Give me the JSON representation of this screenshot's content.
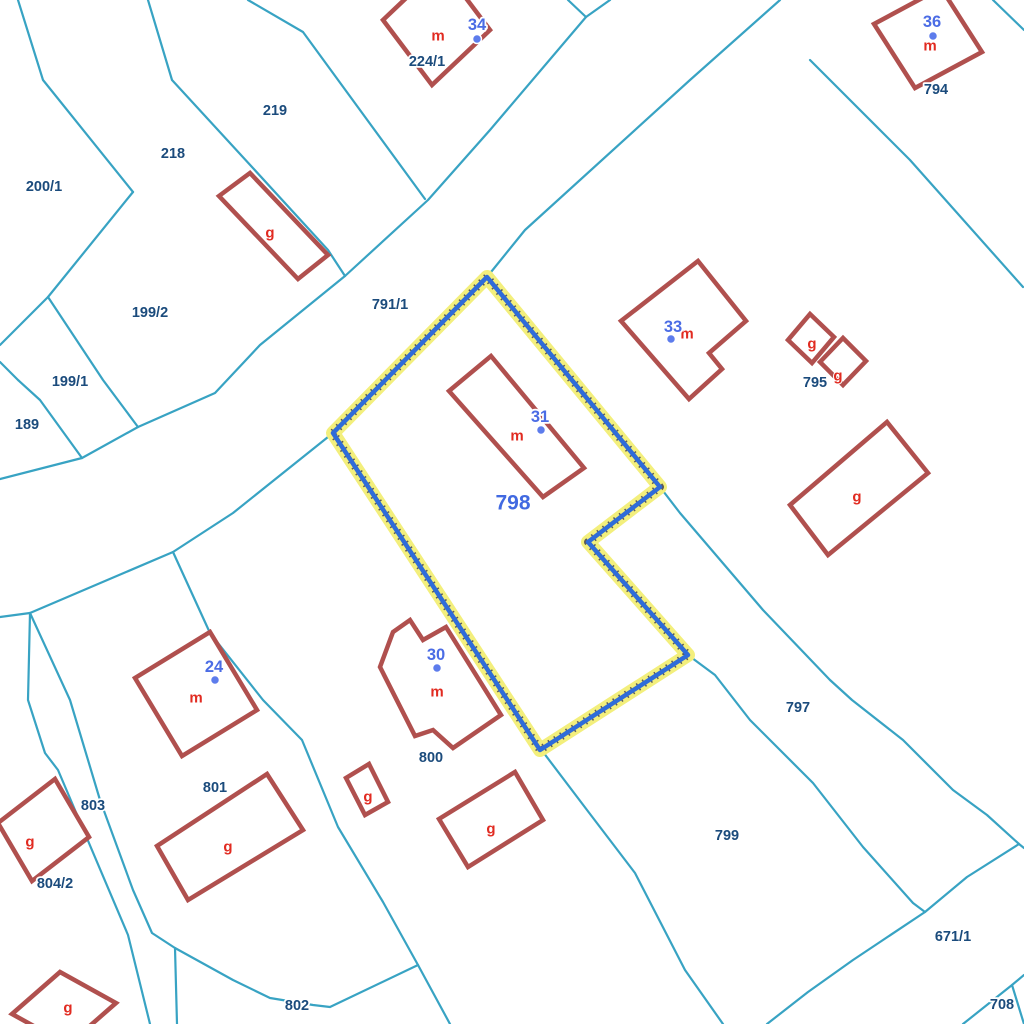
{
  "map": {
    "background": "#ffffff",
    "colors": {
      "parcel_line": "#38a3c3",
      "building_stroke": "#b0504e",
      "building_fill": "#ffffff",
      "selection_halo": "#f3ef7c",
      "selection_dots": "#5a5a5a",
      "selection_line": "#2f6cd9",
      "parcel_label": "#1b4b7c",
      "selected_parcel_label": "#4169e1",
      "house_number": "#4b6ce5",
      "house_dot": "#5d7cec",
      "type_letter": "#e12b21"
    },
    "parcel_lines": [
      {
        "points": "568,0 586,17 490,130 428,200 345,276 260,345 215,393 138,427 82,458 0,479"
      },
      {
        "points": "610,0 586,17"
      },
      {
        "points": "780,0 690,80 525,230 487,277"
      },
      {
        "points": "333,433 233,513 173,552 30,613 0,617"
      },
      {
        "points": "18,0 43,80 133,192"
      },
      {
        "points": "148,0 172,80 252,167 328,250 345,276"
      },
      {
        "points": "248,0 303,32 425,199"
      },
      {
        "points": "133,192 48,297 0,345"
      },
      {
        "points": "48,297 103,380 138,427"
      },
      {
        "points": "0,362 18,380 40,400 82,458"
      },
      {
        "points": "30,613 28,700 45,753 58,770 128,935 150,1024"
      },
      {
        "points": "30,613 70,700 100,800 133,890 152,933 175,948 177,1024"
      },
      {
        "points": "175,948 233,980 270,998 313,1005 330,1007 418,965"
      },
      {
        "points": "173,552 210,633 263,700 302,740 338,827 383,902 418,965 450,1024"
      },
      {
        "points": "540,748 587,810 635,873 685,970 723,1024"
      },
      {
        "points": "688,655 715,675 750,720 813,783 863,847 913,903 925,912"
      },
      {
        "points": "660,487 680,513 763,610 830,680 852,700 903,740 953,790 987,815 1019,844 1024,848"
      },
      {
        "points": "1019,844 967,877 925,912 880,942 853,960 808,992 767,1024"
      },
      {
        "points": "810,60 910,160 1023,287"
      },
      {
        "points": "993,0 1024,30"
      },
      {
        "points": "963,1024 1012,985 1024,975"
      },
      {
        "points": "1012,985 1024,1024"
      }
    ],
    "selected_parcel": {
      "id": "798",
      "points": "487,277 333,433 540,750 688,655 588,542 660,487",
      "label": {
        "text": "798",
        "x": 513,
        "y": 503
      }
    },
    "buildings": [
      {
        "points": "383,20 441,-35 490,30 432,85"
      },
      {
        "points": "874,24 941,-12 982,52 915,88"
      },
      {
        "points": "219,196 250,173 328,255 298,279"
      },
      {
        "points": "698,261 746,321 709,353 722,369 689,399 621,321"
      },
      {
        "points": "788,340 810,314 834,337 812,363"
      },
      {
        "points": "820,362 843,338 866,361 843,385"
      },
      {
        "points": "790,505 887,422 928,473 828,555"
      },
      {
        "points": "491,356 584,468 543,497 449,391"
      },
      {
        "points": "210,632 257,710 182,756 135,678"
      },
      {
        "points": "380,667 393,632 410,620 423,640 446,627 501,715 453,748 433,730 415,736"
      },
      {
        "points": "267,774 303,830 188,900 157,846"
      },
      {
        "points": "55,779 89,837 32,881 -2,823"
      },
      {
        "points": "369,764 388,802 365,815 346,778"
      },
      {
        "points": "515,772 543,820 468,867 439,819"
      },
      {
        "points": "60,972 116,1003 68,1045 12,1014"
      }
    ],
    "parcel_labels": [
      {
        "text": "219",
        "x": 275,
        "y": 111
      },
      {
        "text": "218",
        "x": 173,
        "y": 154
      },
      {
        "text": "200/1",
        "x": 44,
        "y": 187
      },
      {
        "text": "224/1",
        "x": 427,
        "y": 62
      },
      {
        "text": "199/2",
        "x": 150,
        "y": 313
      },
      {
        "text": "199/1",
        "x": 70,
        "y": 382
      },
      {
        "text": "189",
        "x": 27,
        "y": 425
      },
      {
        "text": "791/1",
        "x": 390,
        "y": 305
      },
      {
        "text": "794",
        "x": 936,
        "y": 90
      },
      {
        "text": "795",
        "x": 815,
        "y": 383
      },
      {
        "text": "797",
        "x": 798,
        "y": 708
      },
      {
        "text": "799",
        "x": 727,
        "y": 836
      },
      {
        "text": "800",
        "x": 431,
        "y": 758
      },
      {
        "text": "801",
        "x": 215,
        "y": 788
      },
      {
        "text": "803",
        "x": 93,
        "y": 806
      },
      {
        "text": "804/2",
        "x": 55,
        "y": 884
      },
      {
        "text": "802",
        "x": 297,
        "y": 1006
      },
      {
        "text": "671/1",
        "x": 953,
        "y": 937
      },
      {
        "text": "708",
        "x": 1002,
        "y": 1005
      }
    ],
    "house_numbers": [
      {
        "text": "34",
        "x": 477,
        "y": 25,
        "dot": {
          "x": 477,
          "y": 39
        }
      },
      {
        "text": "36",
        "x": 932,
        "y": 22,
        "dot": {
          "x": 933,
          "y": 36
        }
      },
      {
        "text": "33",
        "x": 673,
        "y": 327,
        "dot": {
          "x": 671,
          "y": 339
        }
      },
      {
        "text": "31",
        "x": 540,
        "y": 417,
        "dot": {
          "x": 541,
          "y": 430
        }
      },
      {
        "text": "30",
        "x": 436,
        "y": 655,
        "dot": {
          "x": 437,
          "y": 668
        }
      },
      {
        "text": "24",
        "x": 214,
        "y": 667,
        "dot": {
          "x": 215,
          "y": 680
        }
      }
    ],
    "type_letters": [
      {
        "text": "m",
        "x": 438,
        "y": 36
      },
      {
        "text": "m",
        "x": 930,
        "y": 46
      },
      {
        "text": "m",
        "x": 687,
        "y": 334
      },
      {
        "text": "m",
        "x": 517,
        "y": 436
      },
      {
        "text": "m",
        "x": 437,
        "y": 692
      },
      {
        "text": "m",
        "x": 196,
        "y": 698
      },
      {
        "text": "g",
        "x": 270,
        "y": 233
      },
      {
        "text": "g",
        "x": 812,
        "y": 344
      },
      {
        "text": "g",
        "x": 838,
        "y": 376
      },
      {
        "text": "g",
        "x": 857,
        "y": 497
      },
      {
        "text": "g",
        "x": 228,
        "y": 847
      },
      {
        "text": "g",
        "x": 30,
        "y": 842
      },
      {
        "text": "g",
        "x": 368,
        "y": 797
      },
      {
        "text": "g",
        "x": 491,
        "y": 829
      },
      {
        "text": "g",
        "x": 68,
        "y": 1008
      }
    ]
  }
}
